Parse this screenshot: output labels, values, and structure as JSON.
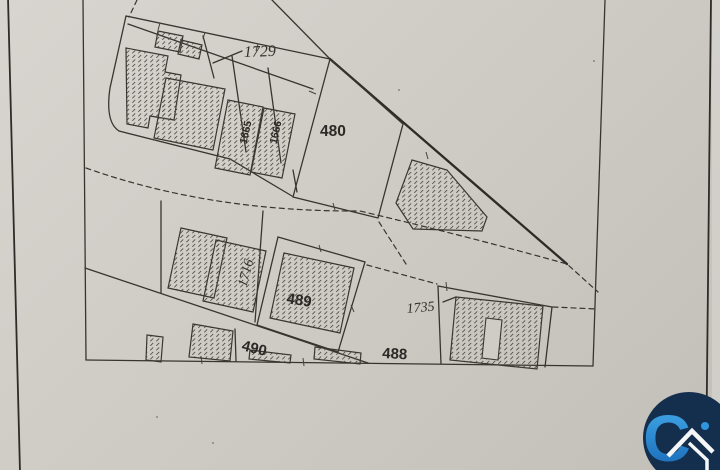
{
  "map": {
    "parcel_labels": {
      "p1729": "1729",
      "p480": "480",
      "p1665": "1665",
      "p1666": "1666",
      "p1716": "1716",
      "p489": "489",
      "p490": "490",
      "p488": "488",
      "p1735": "1735"
    }
  },
  "logo": {
    "letter": "C",
    "icon": "house-roof-icon",
    "colors": {
      "circle": "#142f4e",
      "letter_top": "#45aceb",
      "letter_bottom": "#1566b5",
      "roof": "#f4f6f7",
      "dot": "#2f95dc"
    }
  },
  "colors": {
    "paper": "#cfccc6",
    "ink": "#383530"
  }
}
